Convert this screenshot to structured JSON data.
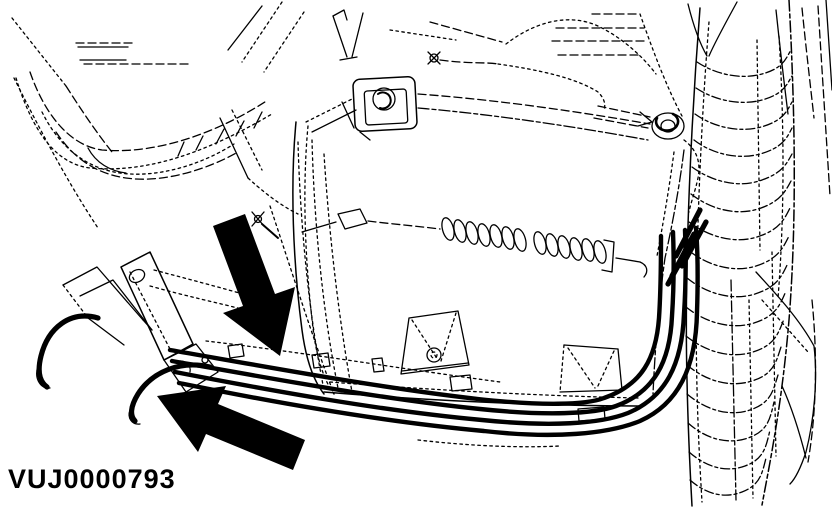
{
  "figure": {
    "caption": "VUJ0000793",
    "ink_color": "#000000",
    "paper_color": "#ffffff",
    "icons": {
      "upper_callout": "solid-arrow-down-icon",
      "lower_callout": "solid-arrow-left-icon"
    }
  }
}
